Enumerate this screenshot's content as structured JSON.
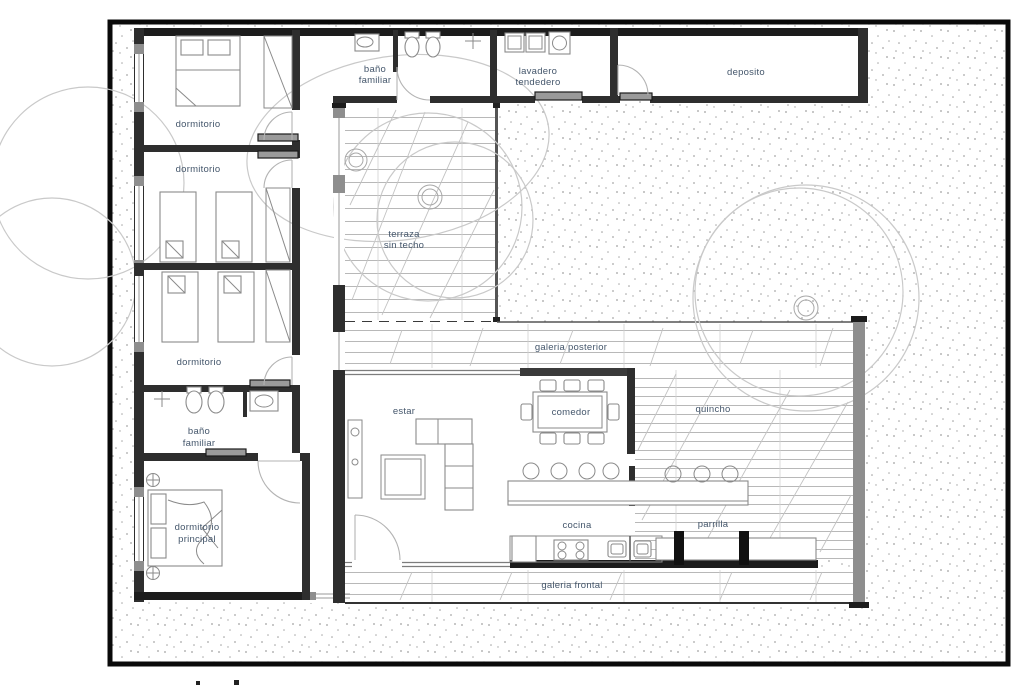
{
  "plan": {
    "rooms": {
      "bano_familiar_top": {
        "line1": "baño",
        "line2": "familiar"
      },
      "lavadero": {
        "line1": "lavadero",
        "line2": "tendedero"
      },
      "deposito": {
        "label": "deposito"
      },
      "dormitorio_1": {
        "label": "dormitorio"
      },
      "dormitorio_2": {
        "label": "dormitorio"
      },
      "dormitorio_3": {
        "label": "dormitorio"
      },
      "terraza": {
        "line1": "terraza",
        "line2": "sin techo"
      },
      "galeria_posterior": {
        "label": "galeria posterior"
      },
      "estar": {
        "label": "estar"
      },
      "comedor": {
        "label": "comedor"
      },
      "quincho": {
        "label": "quincho"
      },
      "bano_familiar_left": {
        "line1": "baño",
        "line2": "familiar"
      },
      "dormitorio_principal": {
        "line1": "dormitorio",
        "line2": "principal"
      },
      "cocina": {
        "label": "cocina"
      },
      "parrilla": {
        "label": "parrilla"
      },
      "galeria_frontal": {
        "label": "galeria frontal"
      }
    },
    "colors": {
      "wall": "#2e2e2e",
      "wall_gray": "#8e8e8e",
      "label_text": "#44566b",
      "plank_line": "#b8b8b8",
      "speckle": "#a0a0a0",
      "tree_outline": "#c9c9c9",
      "paper": "#ffffff"
    }
  }
}
